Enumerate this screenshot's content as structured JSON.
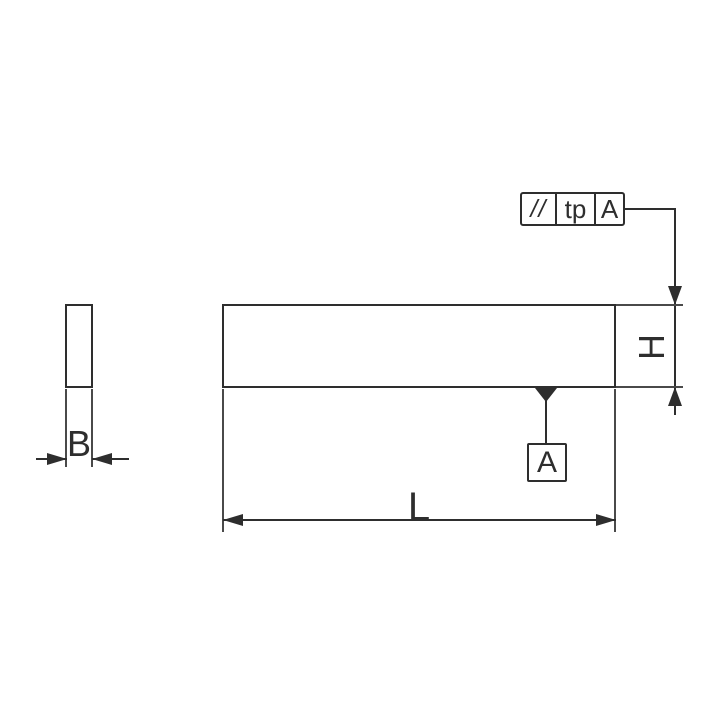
{
  "drawing": {
    "description": "Technical drawing of a parallel key / flat bar with side view and end view",
    "background_color": "#ffffff",
    "line_color": "#2e2e2e"
  },
  "feature_control_frame": {
    "tolerance_symbol": "//",
    "tolerance_symbol_name": "parallelism",
    "tolerance_value": "tp",
    "datum_reference": "A"
  },
  "datum": {
    "label": "A"
  },
  "dimensions": {
    "height_label": "H",
    "width_label": "B",
    "length_label": "L"
  }
}
